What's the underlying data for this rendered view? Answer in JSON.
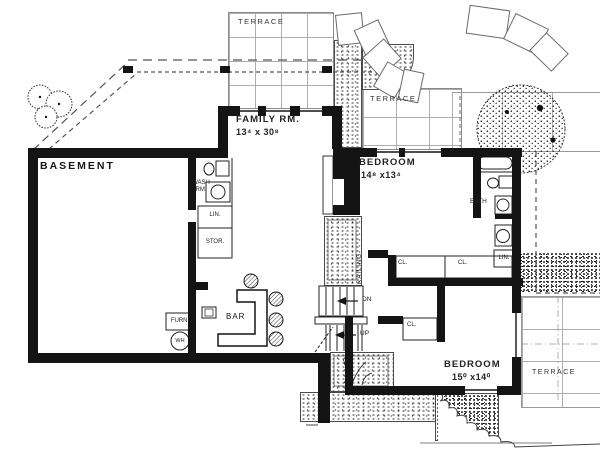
{
  "plan": {
    "terraces": {
      "top": "TERRACE",
      "mid": "TERRACE",
      "bottom": "TERRACE"
    },
    "rooms": {
      "basement": "BASEMENT",
      "family_name": "FAMILY RM.",
      "family_dims": "13⁴ x 30⁸",
      "bedroom1_name": "BEDROOM",
      "bedroom1_dims": "14⁸ x13⁴",
      "bedroom2_name": "BEDROOM",
      "bedroom2_dims": "15⁰ x14⁰",
      "bath": "BATH",
      "wash_line1": "WASH",
      "wash_line2": "RM.",
      "bar": "BAR"
    },
    "closets": {
      "lin_left": "LIN.",
      "stor": "STOR.",
      "lin_right": "LIN.",
      "cl_a": "CL.",
      "cl_b": "CL.",
      "cl_c": "CL."
    },
    "equipment": {
      "furnace": "FURN.",
      "water_heater": "WH"
    },
    "stairs": {
      "down": "DN",
      "up": "UP",
      "railing": "RAILING"
    }
  }
}
